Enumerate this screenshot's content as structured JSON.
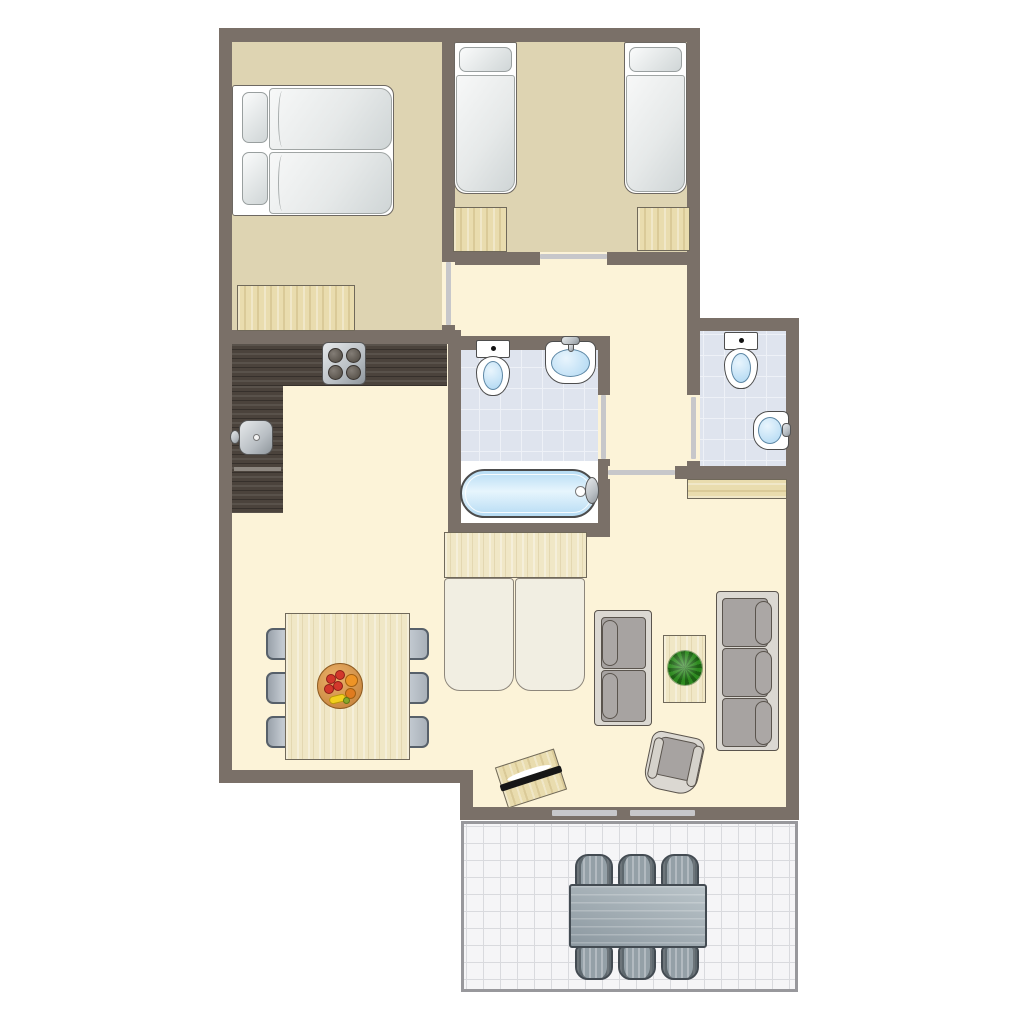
{
  "app": {
    "type": "floor-plan",
    "description": "Top-down 2D floor plan of a holiday apartment with two bedrooms, bathroom, separate WC, open kitchen-living room and a tiled terrace with outdoor dining set"
  },
  "palette": {
    "wall": "#7a7068",
    "floor_bedroom": "#ded4b2",
    "floor_living": "#fcf3d8",
    "floor_tile": "#dfe4ee",
    "tile_line": "#eef1f7",
    "floor_white": "#ffffff",
    "wood": "#e9dcae",
    "wood_light": "#f0e7c6",
    "wood_border": "#70695a",
    "counter": "#4b433c",
    "door_leaf": "#c7c7ca",
    "fixture_border": "#4d4d4d",
    "water_light": "#e9f5fd",
    "water_deep": "#aed7f2",
    "metal": "#b9bfc4",
    "sofa_frame": "#dbd8d2",
    "sofa_cushion": "#a7a3a1",
    "sofa_border": "#5a544d",
    "mattress": "#f1eee2",
    "mattress_border": "#8d867b",
    "bed_white": "#ffffff",
    "bed_border": "#6d6862",
    "chair_border": "#57606a",
    "terrace_bg": "#f5f5f7",
    "terrace_line": "#d9dade",
    "terrace_border": "#98989c",
    "patio_fill": "#94a0a7",
    "patio_border": "#434b52",
    "plant": "#2e8a20",
    "plant_dark": "#1d6114",
    "fruit_red": "#d2372b",
    "fruit_orange": "#ee9426",
    "fruit_yellow": "#f2d01e"
  },
  "rooms": [
    {
      "id": "bedroom-1",
      "kind": "bedroom",
      "furniture": [
        {
          "item": "double-bed",
          "qty": 1
        },
        {
          "item": "pillow",
          "qty": 2
        },
        {
          "item": "wardrobe",
          "qty": 1
        }
      ]
    },
    {
      "id": "bedroom-2",
      "kind": "bedroom",
      "furniture": [
        {
          "item": "single-bed",
          "qty": 2
        },
        {
          "item": "nightstand",
          "qty": 2
        }
      ]
    },
    {
      "id": "hallway",
      "kind": "hallway",
      "furniture": []
    },
    {
      "id": "bathroom",
      "kind": "bathroom",
      "furniture": [
        {
          "item": "toilet",
          "qty": 1
        },
        {
          "item": "washbasin",
          "qty": 1
        },
        {
          "item": "bathtub",
          "qty": 1
        }
      ]
    },
    {
      "id": "wc",
      "kind": "toilet-room",
      "furniture": [
        {
          "item": "toilet",
          "qty": 1
        },
        {
          "item": "corner-washbasin",
          "qty": 1
        }
      ]
    },
    {
      "id": "kitchen-dining",
      "kind": "open-kitchen",
      "furniture": [
        {
          "item": "l-shaped-counter",
          "qty": 1
        },
        {
          "item": "stove-4-burners",
          "qty": 1
        },
        {
          "item": "kitchen-sink",
          "qty": 1
        },
        {
          "item": "dining-table",
          "qty": 1
        },
        {
          "item": "dining-chair",
          "qty": 6
        },
        {
          "item": "fruit-bowl",
          "qty": 1
        }
      ]
    },
    {
      "id": "living-room",
      "kind": "living-room",
      "furniture": [
        {
          "item": "sofa-bed-mattress",
          "qty": 2
        },
        {
          "item": "sofa-bed-cabinet",
          "qty": 1
        },
        {
          "item": "two-seat-sofa",
          "qty": 1
        },
        {
          "item": "three-seat-sofa",
          "qty": 1
        },
        {
          "item": "coffee-table",
          "qty": 1
        },
        {
          "item": "plant",
          "qty": 1
        },
        {
          "item": "armchair",
          "qty": 1
        },
        {
          "item": "tv-sideboard",
          "qty": 1
        },
        {
          "item": "sideboard",
          "qty": 1
        }
      ]
    },
    {
      "id": "terrace",
      "kind": "terrace",
      "furniture": [
        {
          "item": "outdoor-table",
          "qty": 1
        },
        {
          "item": "outdoor-chair",
          "qty": 6
        }
      ]
    }
  ],
  "doors": [
    {
      "id": "bedroom-1-door",
      "between": [
        "bedroom-1",
        "hallway"
      ]
    },
    {
      "id": "bedroom-2-door",
      "between": [
        "bedroom-2",
        "hallway"
      ]
    },
    {
      "id": "bathroom-door",
      "between": [
        "bathroom",
        "hallway"
      ]
    },
    {
      "id": "wc-door",
      "between": [
        "wc",
        "hallway"
      ]
    },
    {
      "id": "living-room-door",
      "between": [
        "hallway",
        "living-room"
      ]
    },
    {
      "id": "terrace-sliding-door",
      "between": [
        "living-room",
        "terrace"
      ],
      "panels": 2
    }
  ]
}
